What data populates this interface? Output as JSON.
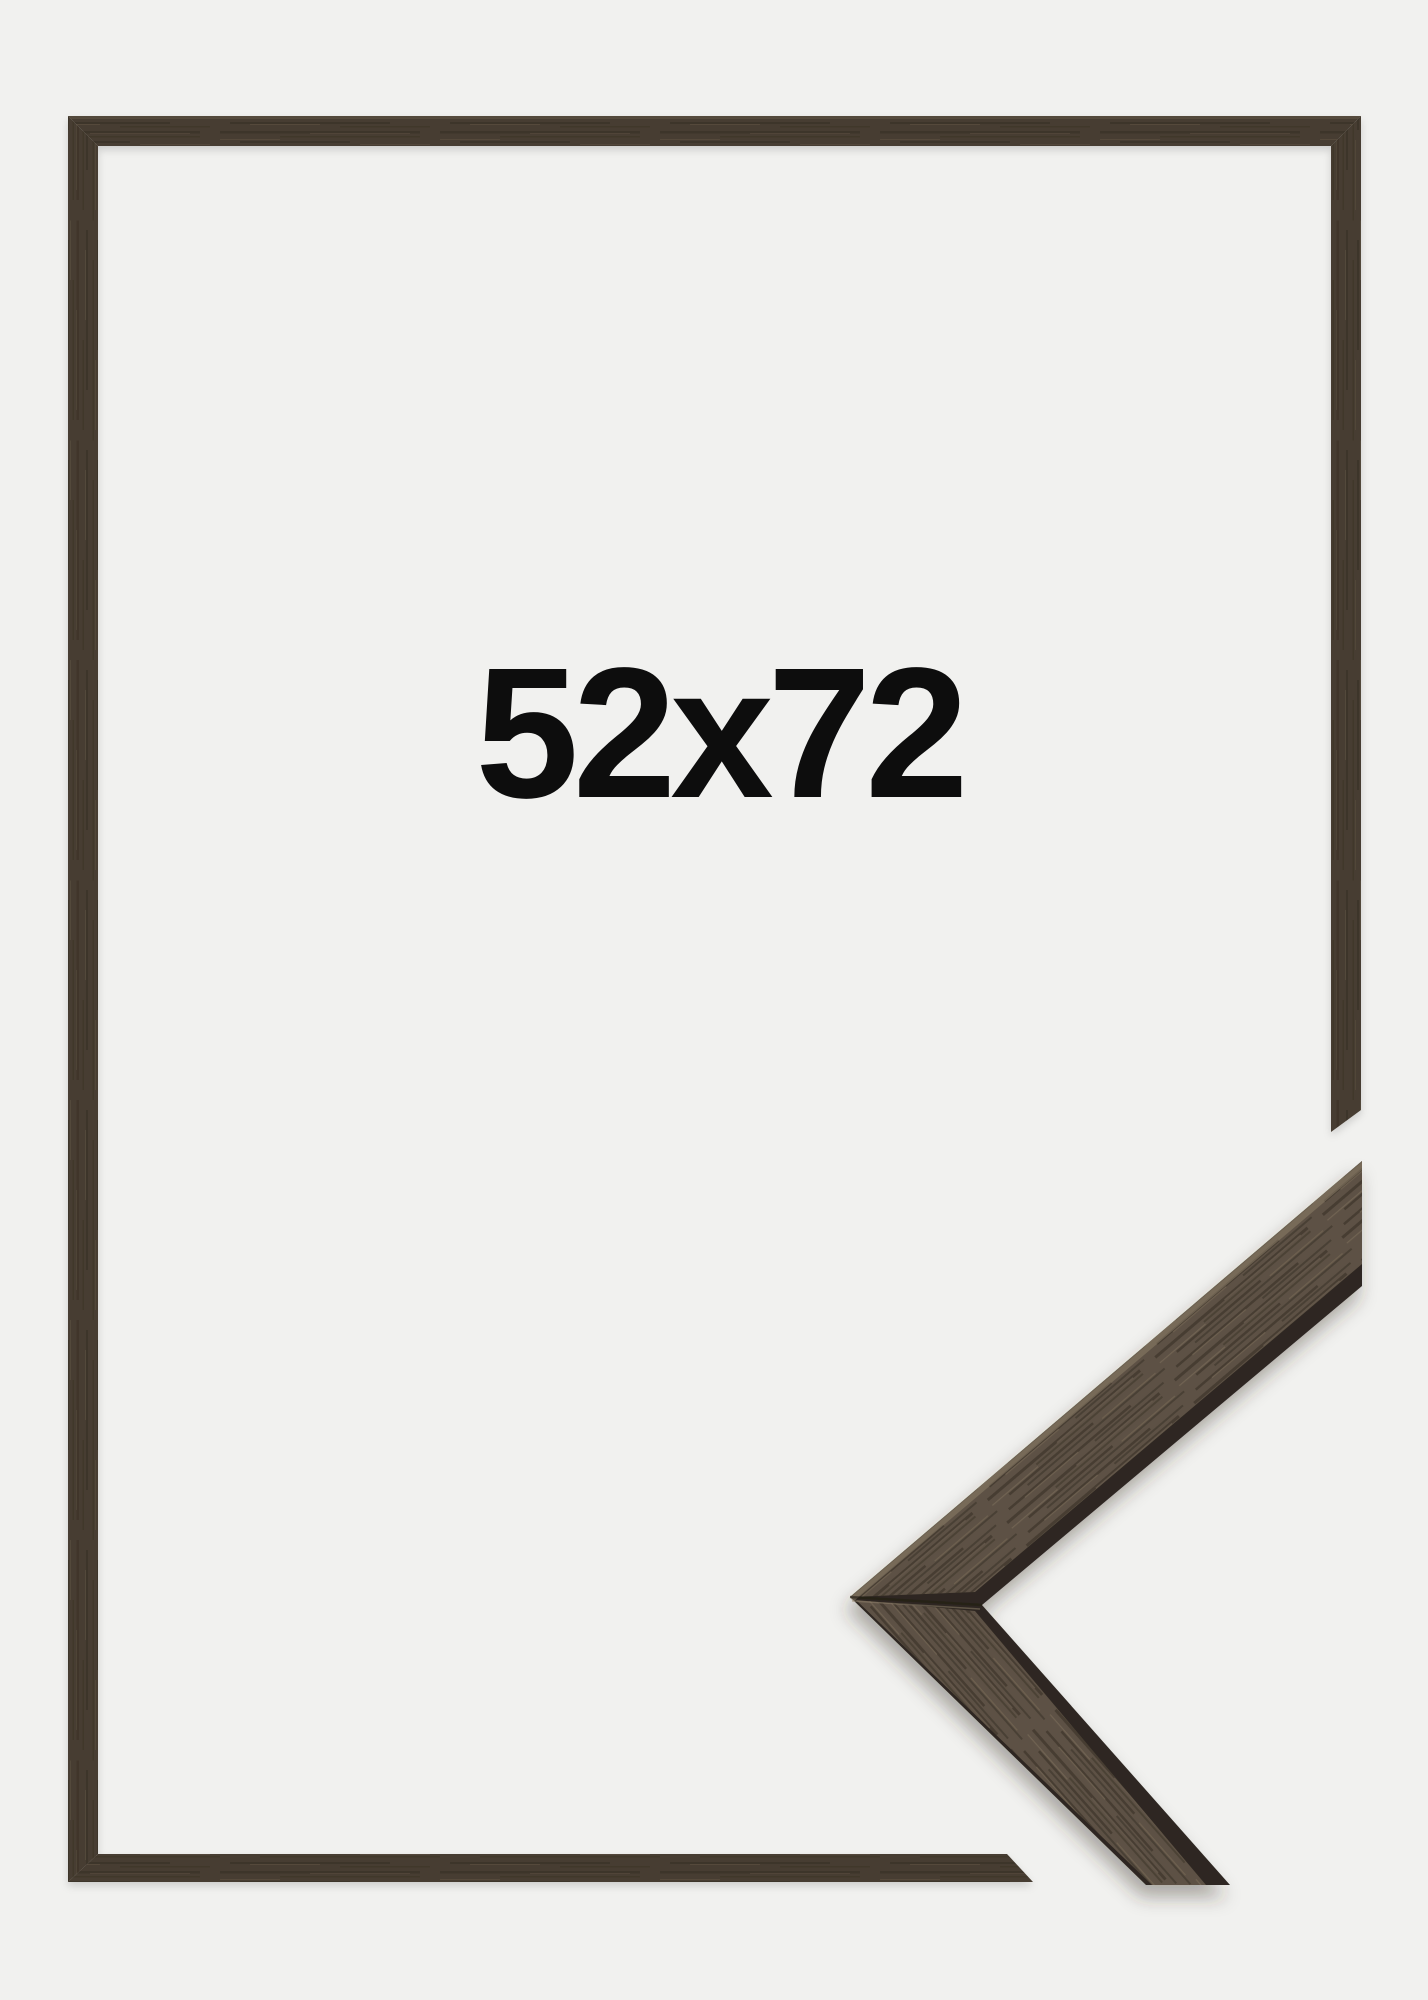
{
  "product": {
    "size_label": "52x72"
  },
  "colors": {
    "background": "#f1f1ef",
    "text_color": "#0d0d0d",
    "frame_wood": "#463c30",
    "frame_wood_light_edge": "#6b5e4e",
    "sample_face": "#5d5144",
    "sample_edge_dark": "#2e2820",
    "grain_dark": "#241e17",
    "grain_light": "#8f7f69"
  }
}
